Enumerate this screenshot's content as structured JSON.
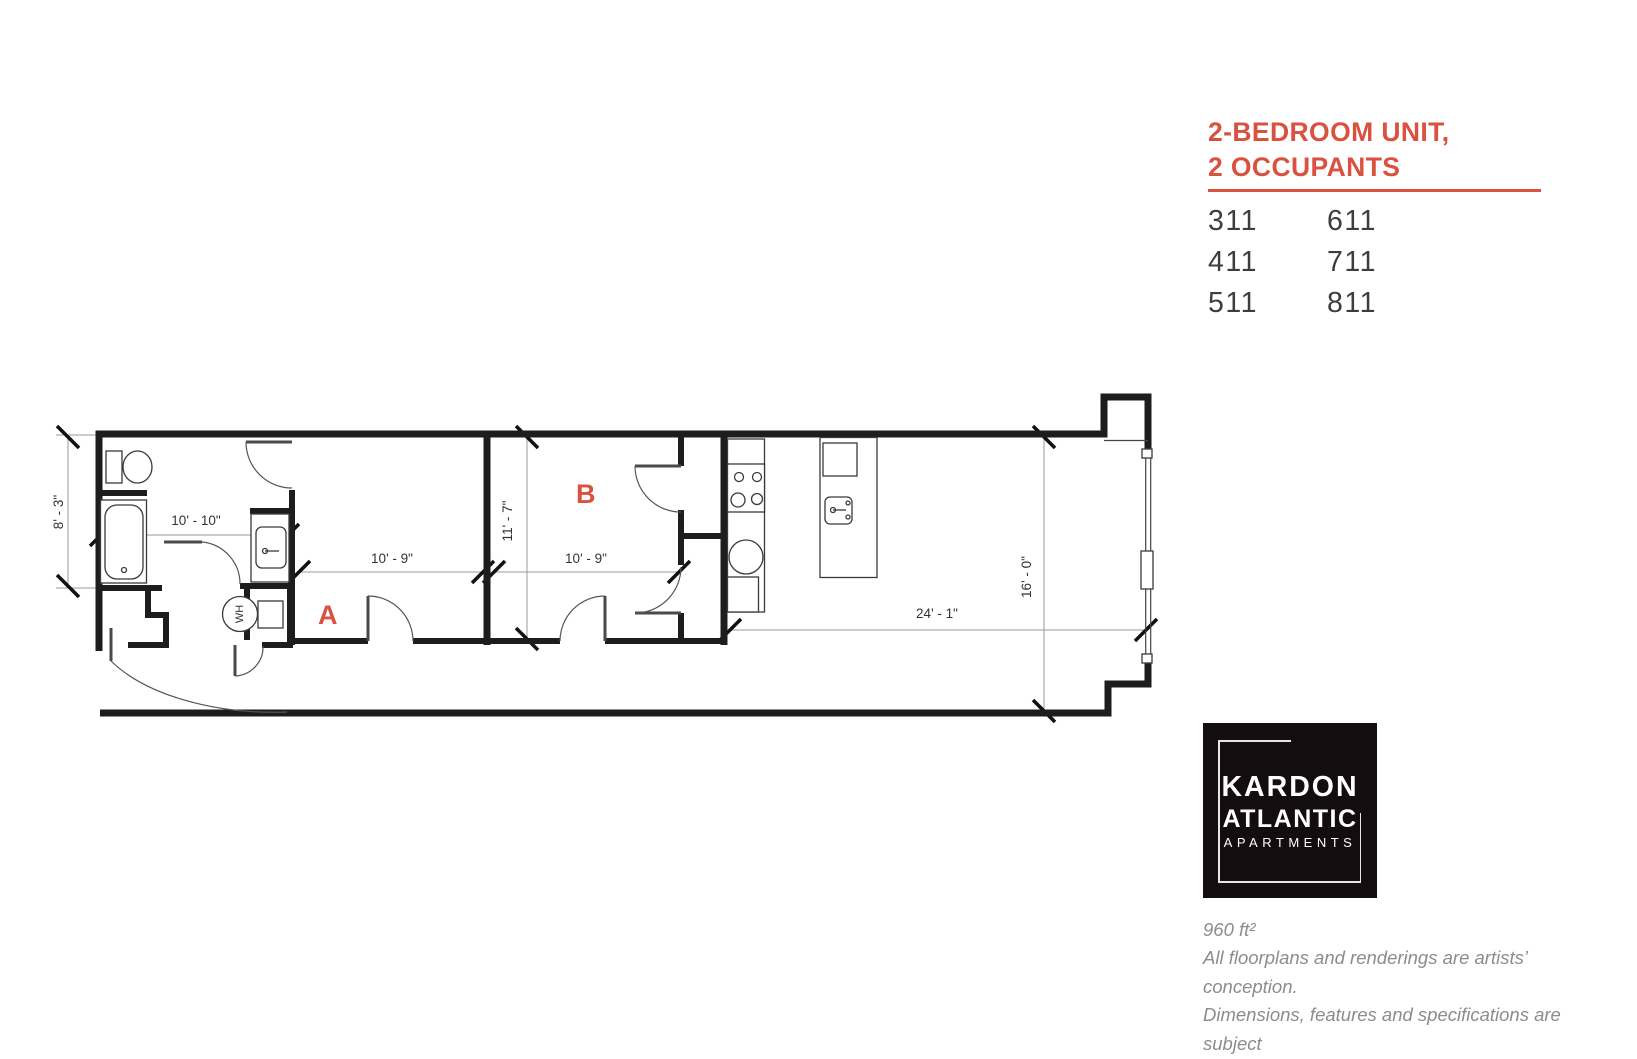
{
  "colors": {
    "accent": "#d8523f",
    "wall": "#1d1d1d",
    "unit_text": "#3d3d3f",
    "footer_text": "#8c8c8c",
    "logo_bg": "#140d0f"
  },
  "header": {
    "title_line1": "2-BEDROOM UNIT,",
    "title_line2": "2 OCCUPANTS",
    "unit_rows": [
      {
        "left": "311",
        "right": "611"
      },
      {
        "left": "411",
        "right": "711"
      },
      {
        "left": "511",
        "right": "811"
      }
    ]
  },
  "floorplan": {
    "room_a_label": "A",
    "room_b_label": "B",
    "water_heater_label": "WH",
    "dimensions": {
      "bath_height": "8' - 3\"",
      "bath_width": "10' - 10\"",
      "bedroom_a_width": "10' - 9\"",
      "bedroom_b_depth": "11' - 7\"",
      "bedroom_b_width": "10' - 9\"",
      "living_length": "24' - 1\"",
      "living_depth": "16' - 0\""
    }
  },
  "logo": {
    "name_line1": "KARDON",
    "name_line2": "ATLANTIC",
    "name_line3": "APARTMENTS"
  },
  "footer": {
    "area": "960 ft²",
    "disclaimer_line1": "All floorplans and renderings are artists’ conception.",
    "disclaimer_line2": "Dimensions, features and specifications are subject",
    "disclaimer_line3": "to change at the discretion of the builder."
  }
}
